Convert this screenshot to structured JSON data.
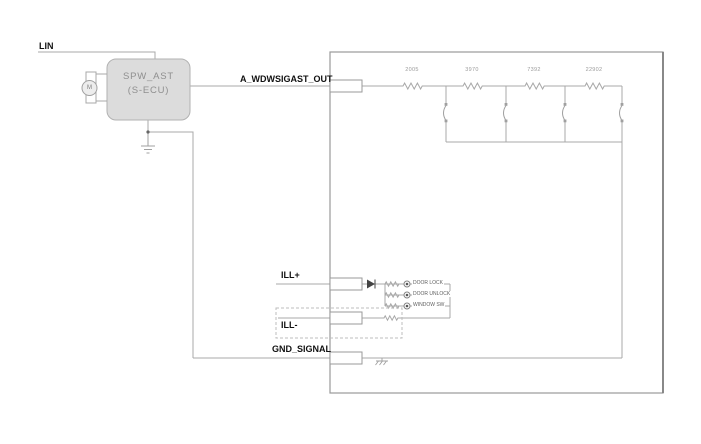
{
  "labels": {
    "lin": "LIN",
    "out": "A_WDWSIGAST_OUT",
    "ill_plus": "ILL+",
    "ill_minus": "ILL-",
    "gnd_signal": "GND_SIGNAL"
  },
  "ecu": {
    "name": "SPW_AST",
    "type": "(S-ECU)",
    "motor": "M"
  },
  "resistor_values": [
    "2005",
    "3970",
    "7392",
    "22902"
  ],
  "led_labels": [
    "DOOR LOCK",
    "DOOR UNLOCK",
    "WINDOW SW"
  ],
  "colors": {
    "wire": "#a8a8a8",
    "box_outline": "#9a9a9a",
    "label_text": "#111111",
    "ecu_fill": "#dcdcdc",
    "ecu_text": "#8f8f8f",
    "value_text": "#9b9b9b"
  }
}
